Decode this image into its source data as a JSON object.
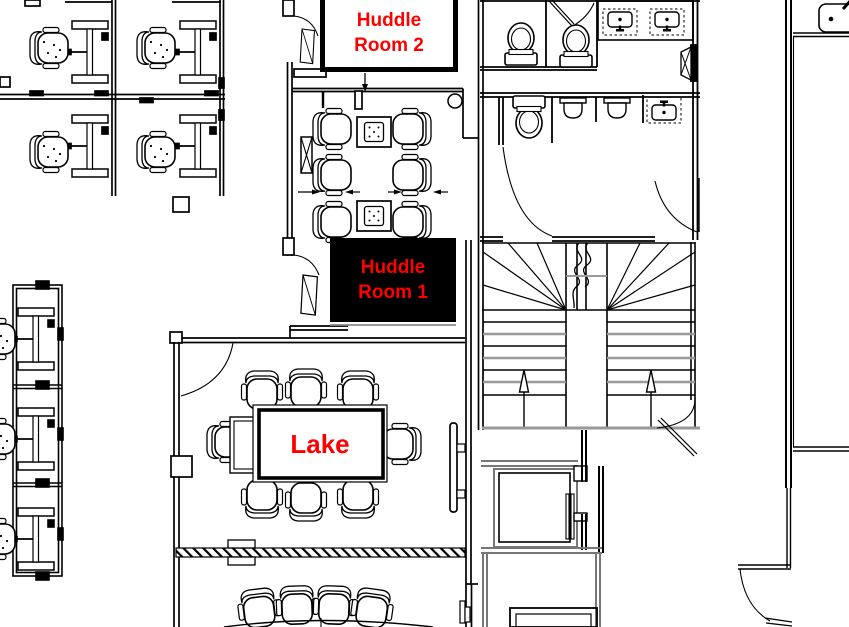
{
  "floorplan": {
    "rooms": {
      "huddle2": {
        "line1": "Huddle",
        "line2": "Room 2",
        "highlighted": false
      },
      "huddle1": {
        "line1": "Huddle",
        "line2": "Room 1",
        "highlighted": true
      },
      "lake": {
        "label": "Lake",
        "highlighted": false
      }
    },
    "colors": {
      "room_label": "#ff0000",
      "selected_room_fill": "#000000",
      "wall_line": "#000000",
      "secondary_line": "#8a8a8a",
      "background": "#ffffff"
    }
  }
}
